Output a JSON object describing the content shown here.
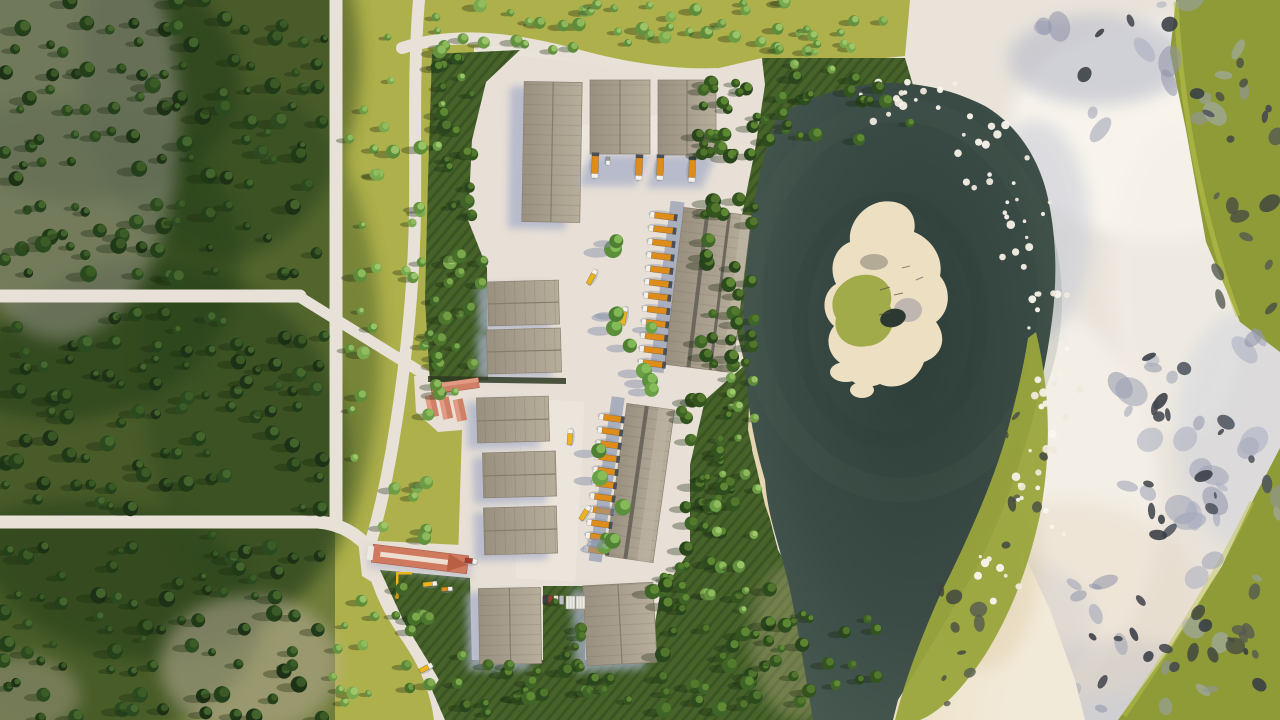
{
  "figure": {
    "label": "Aerial top-down 3D architectural rendering of an industrial logistics park with warehouses, loading trucks, a forest to the west, a dark teal lake with a sandy island, and a snowy rocky slope to the east"
  },
  "scene": {
    "palette": {
      "snow": "#e9e3da",
      "meadow": "#aeb04b",
      "forest": "#6f7c3a",
      "grass": "#47632a",
      "pavement": "#e8e0d6",
      "road": "#e8e1d7",
      "shadow": "#a7afc8",
      "apron": "#99a2b6",
      "lake0": "#2e3e39",
      "lake1": "#3a4b45",
      "lake2": "#4c5d55",
      "beach0": "#e2d0a8",
      "beach1": "#f2ead9",
      "roof0": "#9a9080",
      "roof1": "#b7ad9b",
      "roofStripe": "#6b675c",
      "ridge": "#857c6b",
      "islandSand": "#ecdfc2",
      "islandGreen": "#9aa53c",
      "pond": "#2c3933",
      "greenPatch": "#8f9b37",
      "greenShore": "#9aa53c",
      "limeEdge": "#bcc44e",
      "redRoof": "#cf7a5e",
      "shedRoof": "#d08066",
      "hedge": "#3f5c26"
    },
    "treePalettes": {
      "dark": {
        "base": [
          "#1c3115",
          "#24401a",
          "#2b4a1f",
          "#203a18"
        ],
        "hl": [
          "#3f5f28",
          "#4a6c30"
        ]
      },
      "mixeddark": {
        "base": [
          "#28451d",
          "#33541f",
          "#3f6427",
          "#2c4c1e"
        ],
        "hl": [
          "#577d2f",
          "#659036"
        ]
      },
      "mixed": {
        "base": [
          "#3f6427",
          "#4d752e",
          "#5a8638",
          "#467029"
        ],
        "hl": [
          "#79a348",
          "#86b152"
        ]
      },
      "light": {
        "base": [
          "#5d8c3a",
          "#6c9c44",
          "#7aa94e",
          "#639140"
        ],
        "hl": [
          "#95c162",
          "#a3cd6e"
        ]
      },
      "rowgreen": {
        "base": [
          "#4e7f33",
          "#5b8f3c",
          "#69a046"
        ],
        "hl": [
          "#8cc25c"
        ]
      }
    },
    "rockPalettes": {
      "rockLight": {
        "colors": [
          "#9ba0b4",
          "#a8adc0",
          "#8f94a9"
        ],
        "op": 0.55
      },
      "rockDark": {
        "colors": [
          "#43474f",
          "#383c44",
          "#50545e"
        ],
        "op": 0.88
      },
      "rockOnGreen": {
        "colors": [
          "#474c42",
          "#3c4240",
          "#555a50"
        ],
        "op": 0.8
      }
    },
    "foamColors": [
      "#f5f0e6",
      "#efe9dc",
      "#faf6ee"
    ],
    "vehicleColors": {
      "orange": "#df8d1a",
      "yellow": "#eab41f",
      "red": "#b03a2a",
      "gray": "#9a9a98"
    },
    "treeZones": [
      {
        "id": "forest",
        "grid": true,
        "rect": [
          0,
          0,
          335,
          720
        ],
        "step": 23,
        "jitter": 9,
        "skip": 0.3,
        "rmin": 4,
        "rmax": 8.5,
        "pal": "dark",
        "seed": 7,
        "avoid": "forest"
      },
      {
        "id": "meadow",
        "rect": [
          346,
          0,
          116,
          540
        ],
        "count": 52,
        "rmin": 3.5,
        "rmax": 7,
        "pal": "light",
        "seed": 11,
        "avoid": "v2"
      },
      {
        "id": "meadow-bottom",
        "rect": [
          332,
          578,
          52,
          130
        ],
        "count": 10,
        "rmin": 3.5,
        "rmax": 6.5,
        "pal": "light",
        "seed": 12
      },
      {
        "id": "top-strip",
        "rect": [
          460,
          0,
          330,
          50
        ],
        "count": 38,
        "rmin": 3.5,
        "rmax": 7,
        "pal": "light",
        "seed": 13,
        "avoid": "h3"
      },
      {
        "id": "top-strip-east",
        "rect": [
          790,
          8,
          112,
          66
        ],
        "count": 13,
        "rmin": 3,
        "rmax": 6,
        "pal": "light",
        "seed": 14
      },
      {
        "id": "hedge",
        "rect": [
          436,
          58,
          40,
          160
        ],
        "count": 18,
        "rmin": 4,
        "rmax": 7.5,
        "pal": "mixeddark",
        "seed": 15
      },
      {
        "id": "lawn-west",
        "rect": [
          426,
          240,
          58,
          136
        ],
        "count": 15,
        "rmin": 4,
        "rmax": 7.5,
        "pal": "mixed",
        "seed": 16
      },
      {
        "id": "shore-1",
        "rect": [
          692,
          72,
          70,
          98
        ],
        "count": 24,
        "rmin": 4,
        "rmax": 8,
        "pal": "mixeddark",
        "seed": 17
      },
      {
        "id": "shore-1b",
        "rect": [
          762,
          76,
          148,
          64
        ],
        "count": 20,
        "rmin": 4,
        "rmax": 7.5,
        "pal": "mixeddark",
        "seed": 34
      },
      {
        "id": "shore-2",
        "rect": [
          700,
          196,
          56,
          184
        ],
        "count": 28,
        "rmin": 4,
        "rmax": 8,
        "pal": "mixeddark",
        "seed": 18
      },
      {
        "id": "shore-3",
        "rect": [
          676,
          400,
          66,
          168
        ],
        "count": 30,
        "rmin": 4,
        "rmax": 8,
        "pal": "mixeddark",
        "seed": 19
      },
      {
        "id": "shore-4",
        "rect": [
          652,
          574,
          118,
          140
        ],
        "count": 32,
        "rmin": 4,
        "rmax": 8,
        "pal": "mixeddark",
        "seed": 20
      },
      {
        "id": "shore-5",
        "rect": [
          764,
          602,
          118,
          108
        ],
        "count": 20,
        "rmin": 4,
        "rmax": 7.5,
        "pal": "mixeddark",
        "seed": 21
      },
      {
        "id": "beach-trees-1",
        "rect": [
          702,
          462,
          56,
          160
        ],
        "count": 12,
        "rmin": 3.5,
        "rmax": 6.5,
        "pal": "light",
        "seed": 22
      },
      {
        "id": "beach-trees-2",
        "rect": [
          722,
          352,
          38,
          112
        ],
        "count": 7,
        "rmin": 3,
        "rmax": 6,
        "pal": "light",
        "seed": 23
      },
      {
        "id": "cd1-row",
        "rect": [
          612,
          220,
          22,
          128
        ],
        "count": 6,
        "rmin": 6,
        "rmax": 9,
        "pal": "rowgreen",
        "seed": 27,
        "pavement": true
      },
      {
        "id": "yard-mid",
        "rect": [
          638,
          284,
          24,
          106
        ],
        "count": 4,
        "rmin": 5,
        "rmax": 8,
        "pal": "rowgreen",
        "seed": 28,
        "pavement": true
      },
      {
        "id": "cd2-row",
        "rect": [
          598,
          432,
          26,
          126
        ],
        "count": 6,
        "rmin": 5,
        "rmax": 8.5,
        "pal": "rowgreen",
        "seed": 29,
        "pavement": true
      },
      {
        "id": "lawn-south",
        "rect": [
          392,
          588,
          72,
          100
        ],
        "count": 11,
        "rmin": 4,
        "rmax": 7.5,
        "pal": "mixed",
        "seed": 30
      },
      {
        "id": "lawn-mid",
        "rect": [
          546,
          596,
          36,
          72
        ],
        "count": 7,
        "rmin": 4,
        "rmax": 7,
        "pal": "mixeddark",
        "seed": 31
      },
      {
        "id": "bottom-strip",
        "rect": [
          458,
          664,
          196,
          50
        ],
        "count": 20,
        "rmin": 4,
        "rmax": 7.5,
        "pal": "mixeddark",
        "seed": 32
      }
    ],
    "rockZones": [
      {
        "rect": [
          1040,
          0,
          240,
          130
        ],
        "count": 16,
        "pal": "rockLight",
        "smin": 5,
        "smax": 16,
        "seed": 41,
        "layer": 1
      },
      {
        "rect": [
          1080,
          10,
          200,
          120
        ],
        "count": 8,
        "pal": "rockDark",
        "smin": 3,
        "smax": 9,
        "seed": 42,
        "layer": 1
      },
      {
        "rect": [
          1110,
          330,
          170,
          210
        ],
        "count": 26,
        "pal": "rockLight",
        "smin": 6,
        "smax": 18,
        "seed": 43,
        "layer": 1
      },
      {
        "rect": [
          1120,
          350,
          160,
          190
        ],
        "count": 18,
        "pal": "rockDark",
        "smin": 3,
        "smax": 10,
        "seed": 44,
        "layer": 1
      },
      {
        "rect": [
          1040,
          560,
          220,
          150
        ],
        "count": 18,
        "pal": "rockLight",
        "smin": 5,
        "smax": 14,
        "seed": 45,
        "layer": 1
      },
      {
        "rect": [
          1070,
          580,
          190,
          130
        ],
        "count": 12,
        "pal": "rockDark",
        "smin": 3,
        "smax": 8,
        "seed": 46,
        "layer": 1
      },
      {
        "rect": [
          1195,
          55,
          85,
          260
        ],
        "count": 14,
        "pal": "rockOnGreen",
        "smin": 4,
        "smax": 12,
        "seed": 47,
        "layer": 1
      },
      {
        "rect": [
          1190,
          560,
          90,
          150
        ],
        "count": 10,
        "pal": "rockOnGreen",
        "smin": 4,
        "smax": 10,
        "seed": 48,
        "layer": 1
      },
      {
        "rect": [
          955,
          600,
          100,
          105
        ],
        "count": 8,
        "pal": "rockLight",
        "smin": 4,
        "smax": 10,
        "seed": 49,
        "layer": 1
      },
      {
        "rect": [
          930,
          556,
          55,
          150
        ],
        "count": 9,
        "pal": "rockOnGreen",
        "smin": 3,
        "smax": 9,
        "seed": 50,
        "layer": 2
      },
      {
        "rect": [
          1006,
          410,
          40,
          140
        ],
        "count": 7,
        "pal": "rockOnGreen",
        "smin": 3,
        "smax": 8,
        "seed": 59,
        "layer": 2
      }
    ],
    "foamZones": [
      {
        "rect": [
          840,
          78,
          130,
          48
        ],
        "count": 16,
        "seed": 51
      },
      {
        "rect": [
          955,
          118,
          75,
          70
        ],
        "count": 13,
        "seed": 52
      },
      {
        "rect": [
          1002,
          192,
          58,
          88
        ],
        "count": 13,
        "seed": 53
      },
      {
        "rect": [
          1020,
          282,
          48,
          98
        ],
        "count": 12,
        "seed": 54
      },
      {
        "rect": [
          1028,
          382,
          52,
          92
        ],
        "count": 12,
        "seed": 55
      },
      {
        "rect": [
          1002,
          472,
          62,
          78
        ],
        "count": 10,
        "seed": 56
      },
      {
        "rect": [
          962,
          548,
          62,
          62
        ],
        "count": 8,
        "seed": 57
      }
    ],
    "vehicles": {
      "rows": [
        {
          "name": "cd1-docks",
          "x0": 662,
          "y0": 216,
          "dx": -1.05,
          "dy": 13.4,
          "n": 12,
          "a": 187,
          "l": 24,
          "w": 6,
          "color": "orange",
          "dock": true
        },
        {
          "name": "cd2-docks",
          "x0": 610,
          "y0": 418,
          "dx": -1.5,
          "dy": 13.2,
          "n": 11,
          "a": 188,
          "l": 22,
          "w": 6,
          "color": "orange",
          "dock": true
        },
        {
          "name": "b2-docks",
          "x0": 595,
          "y0": 167,
          "dx": 44,
          "dy": 2,
          "n": 2,
          "a": 92,
          "l": 22,
          "w": 6.5,
          "color": "orange",
          "dock": true
        },
        {
          "name": "b3-docks",
          "x0": 660,
          "y0": 169,
          "dx": 32,
          "dy": 2,
          "n": 2,
          "a": 92,
          "l": 22,
          "w": 6.5,
          "color": "orange",
          "dock": true
        }
      ],
      "single": [
        {
          "x": 592,
          "y": 277,
          "a": -62,
          "l": 16,
          "w": 5,
          "color": "yellow"
        },
        {
          "x": 624,
          "y": 316,
          "a": -80,
          "l": 18,
          "w": 5,
          "color": "yellow"
        },
        {
          "x": 570,
          "y": 437,
          "a": -86,
          "l": 16,
          "w": 5,
          "color": "yellow"
        },
        {
          "x": 585,
          "y": 513,
          "a": -58,
          "l": 16,
          "w": 5,
          "color": "yellow"
        },
        {
          "x": 426,
          "y": 668,
          "a": -28,
          "l": 14,
          "w": 5,
          "color": "yellow"
        },
        {
          "x": 430,
          "y": 584,
          "a": -6,
          "l": 14,
          "w": 4.5,
          "color": "yellow"
        },
        {
          "x": 447,
          "y": 589,
          "a": -4,
          "l": 11,
          "w": 4,
          "color": "orange"
        },
        {
          "x": 471,
          "y": 561,
          "a": 8,
          "l": 12,
          "w": 5,
          "color": "red"
        },
        {
          "x": 608,
          "y": 161,
          "a": 90,
          "l": 8,
          "w": 4,
          "color": "gray"
        }
      ],
      "cars": [
        {
          "x": 545,
          "y": 600,
          "c": "#3c3c40"
        },
        {
          "x": 550.5,
          "y": 600,
          "c": "#9a3a32"
        },
        {
          "x": 556,
          "y": 600,
          "c": "#e0dfda"
        },
        {
          "x": 561.5,
          "y": 600,
          "c": "#b9bec6"
        }
      ],
      "containers": [
        {
          "x": 566,
          "y": 596
        },
        {
          "x": 576,
          "y": 596
        }
      ]
    }
  }
}
